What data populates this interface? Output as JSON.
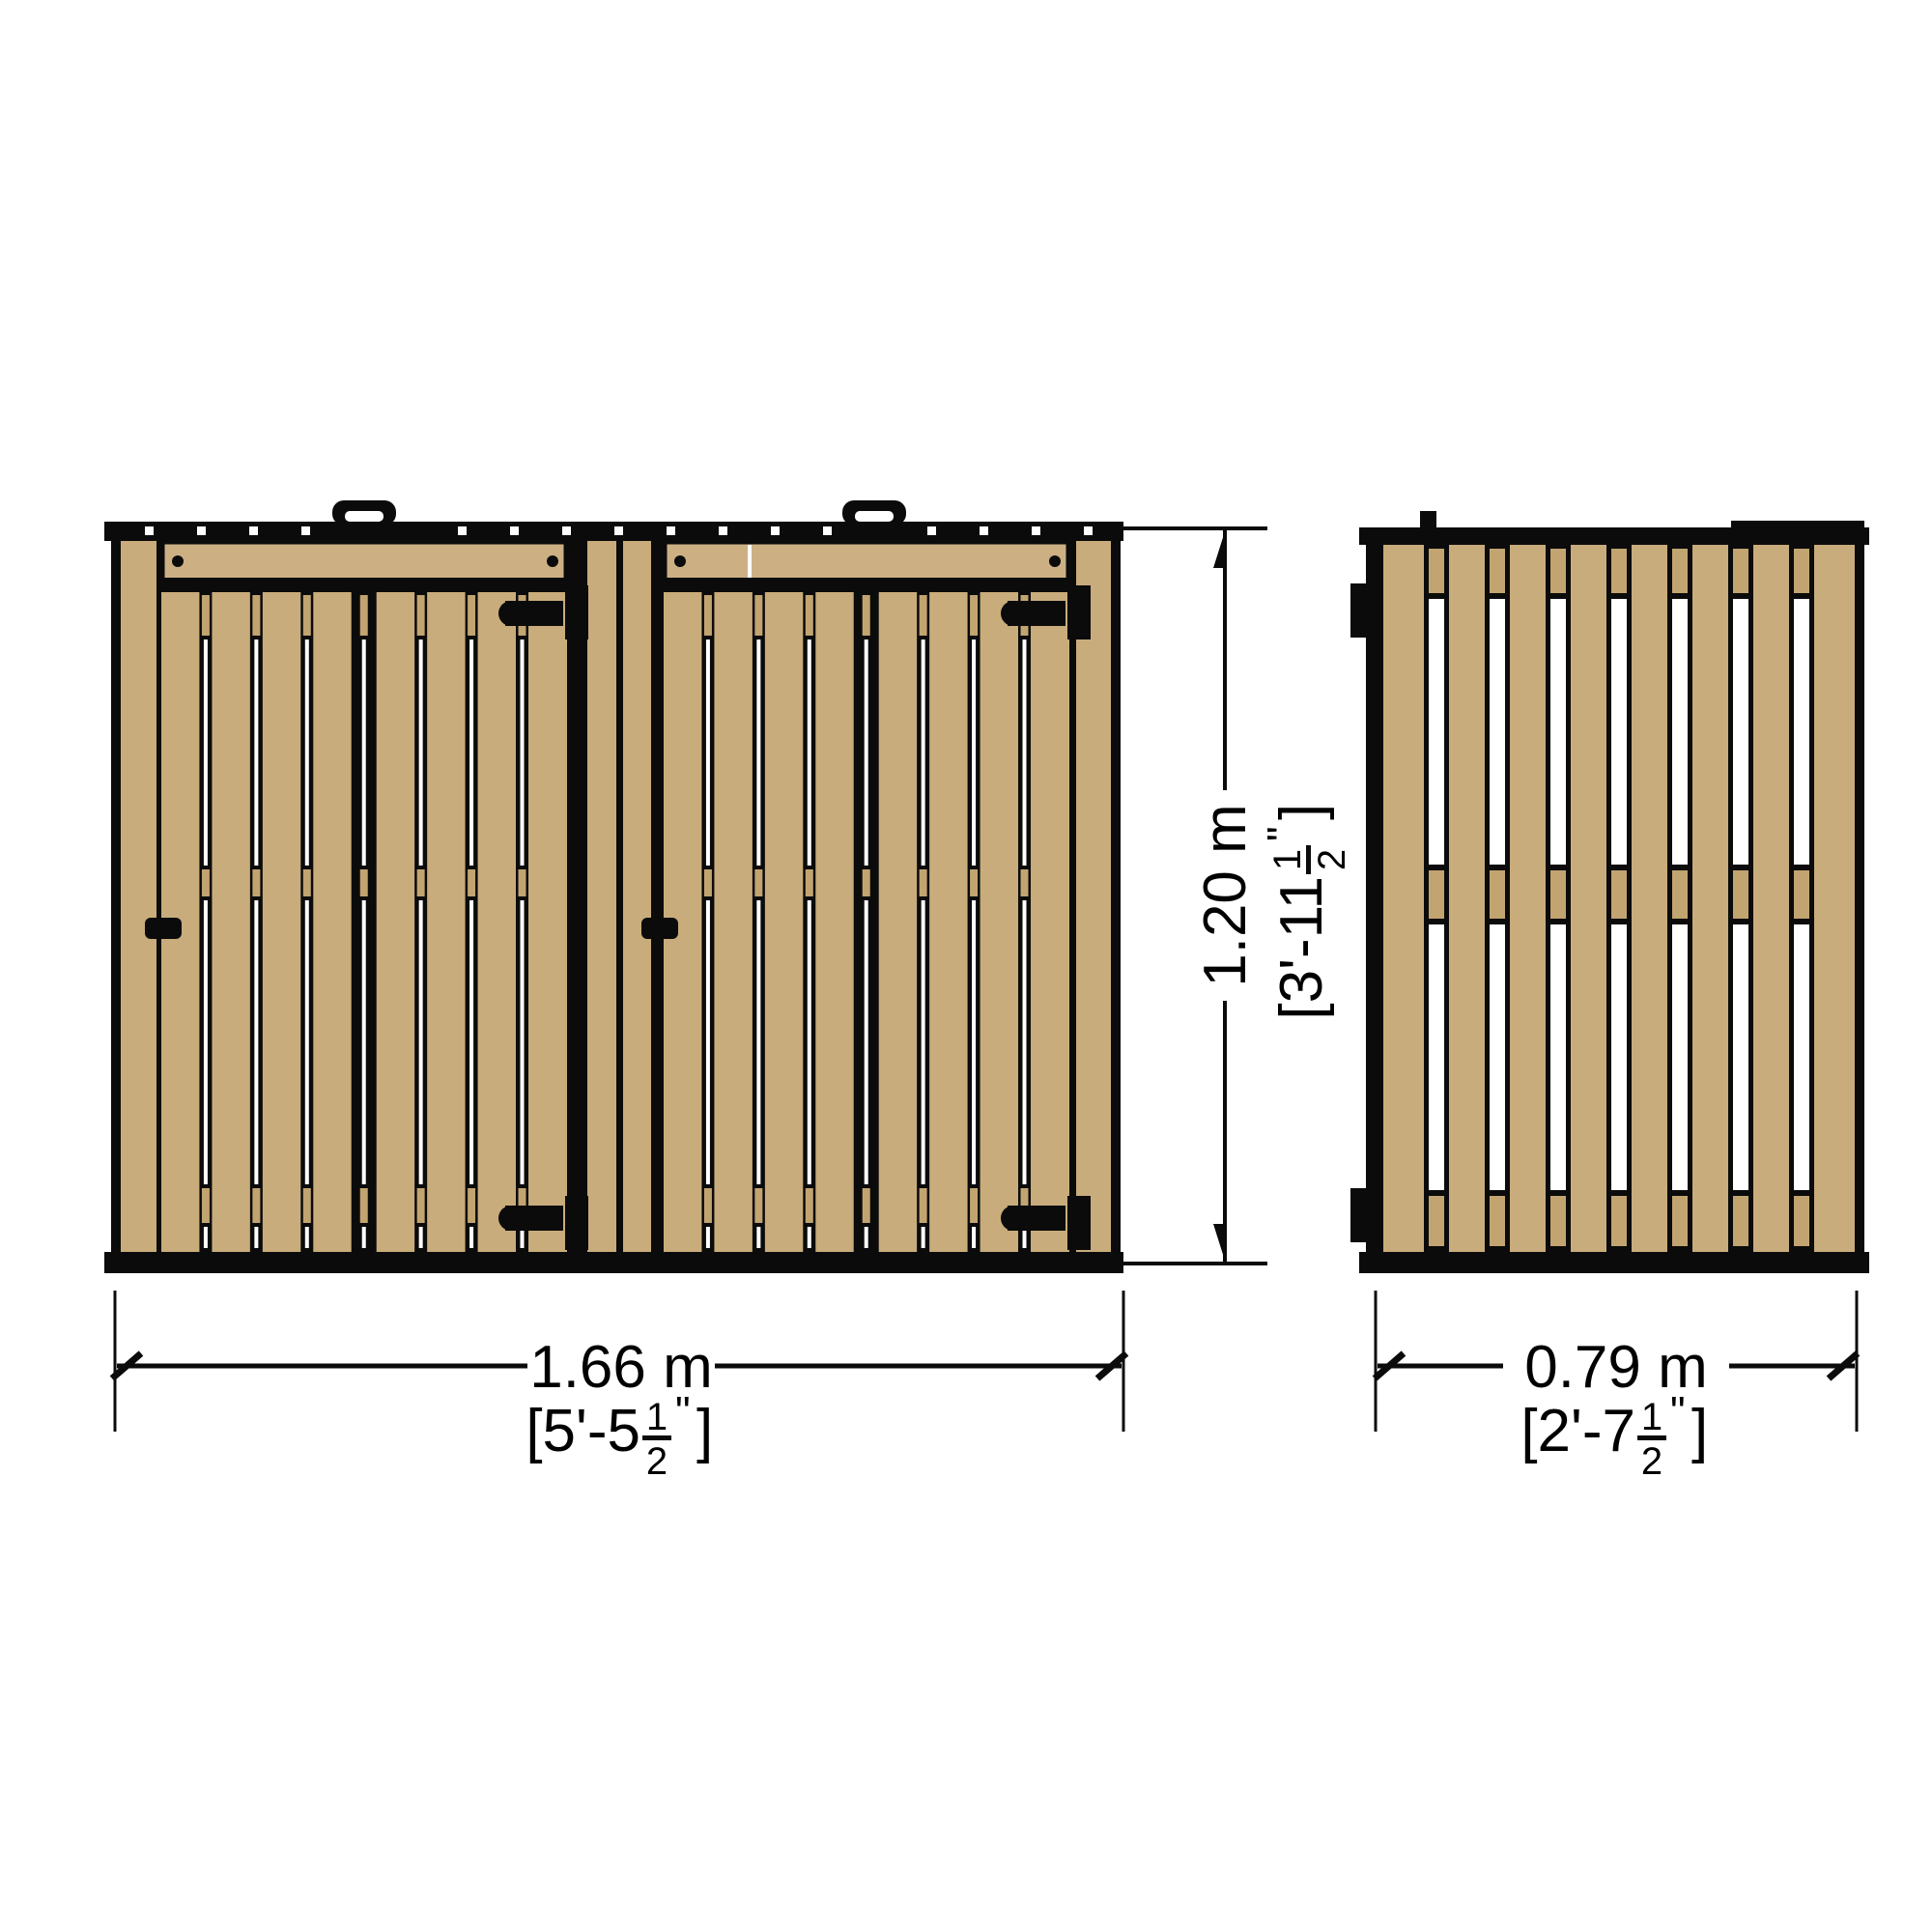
{
  "drawing": {
    "title": "",
    "background": "#ffffff",
    "colors": {
      "wood": "#c9ac7b",
      "wood_rail": "#ccb084",
      "wood_back": "#c2a471",
      "outline": "#0b0b0b",
      "gap_light": "#ffffff",
      "dimension": "#000000"
    },
    "views": [
      {
        "id": "front",
        "name": "front-elevation",
        "doors": 2,
        "slats_per_door": 8,
        "handles": 2,
        "hinges": 4,
        "latches": 2
      },
      {
        "id": "side",
        "name": "side-elevation",
        "slats": 8,
        "rails": 3,
        "brackets": 2
      }
    ],
    "dimensions": {
      "front_width": {
        "metric": "1.66 m",
        "imperial": "[5'-5½\"]",
        "imperial_parts": {
          "prefix": "[5'-5",
          "numerator": "1",
          "denominator": "2",
          "quote": "\"",
          "bracket": "]"
        }
      },
      "height": {
        "metric": "1.20 m",
        "imperial": "[3'-11½\"]",
        "imperial_parts": {
          "prefix": "[3'-11",
          "numerator": "1",
          "denominator": "2",
          "quote": "\"",
          "bracket": "]"
        }
      },
      "side_width": {
        "metric": "0.79 m",
        "imperial": "[2'-7½\"]",
        "imperial_parts": {
          "prefix": "[2'-7",
          "numerator": "1",
          "denominator": "2",
          "quote": "\"",
          "bracket": "]"
        }
      }
    }
  }
}
